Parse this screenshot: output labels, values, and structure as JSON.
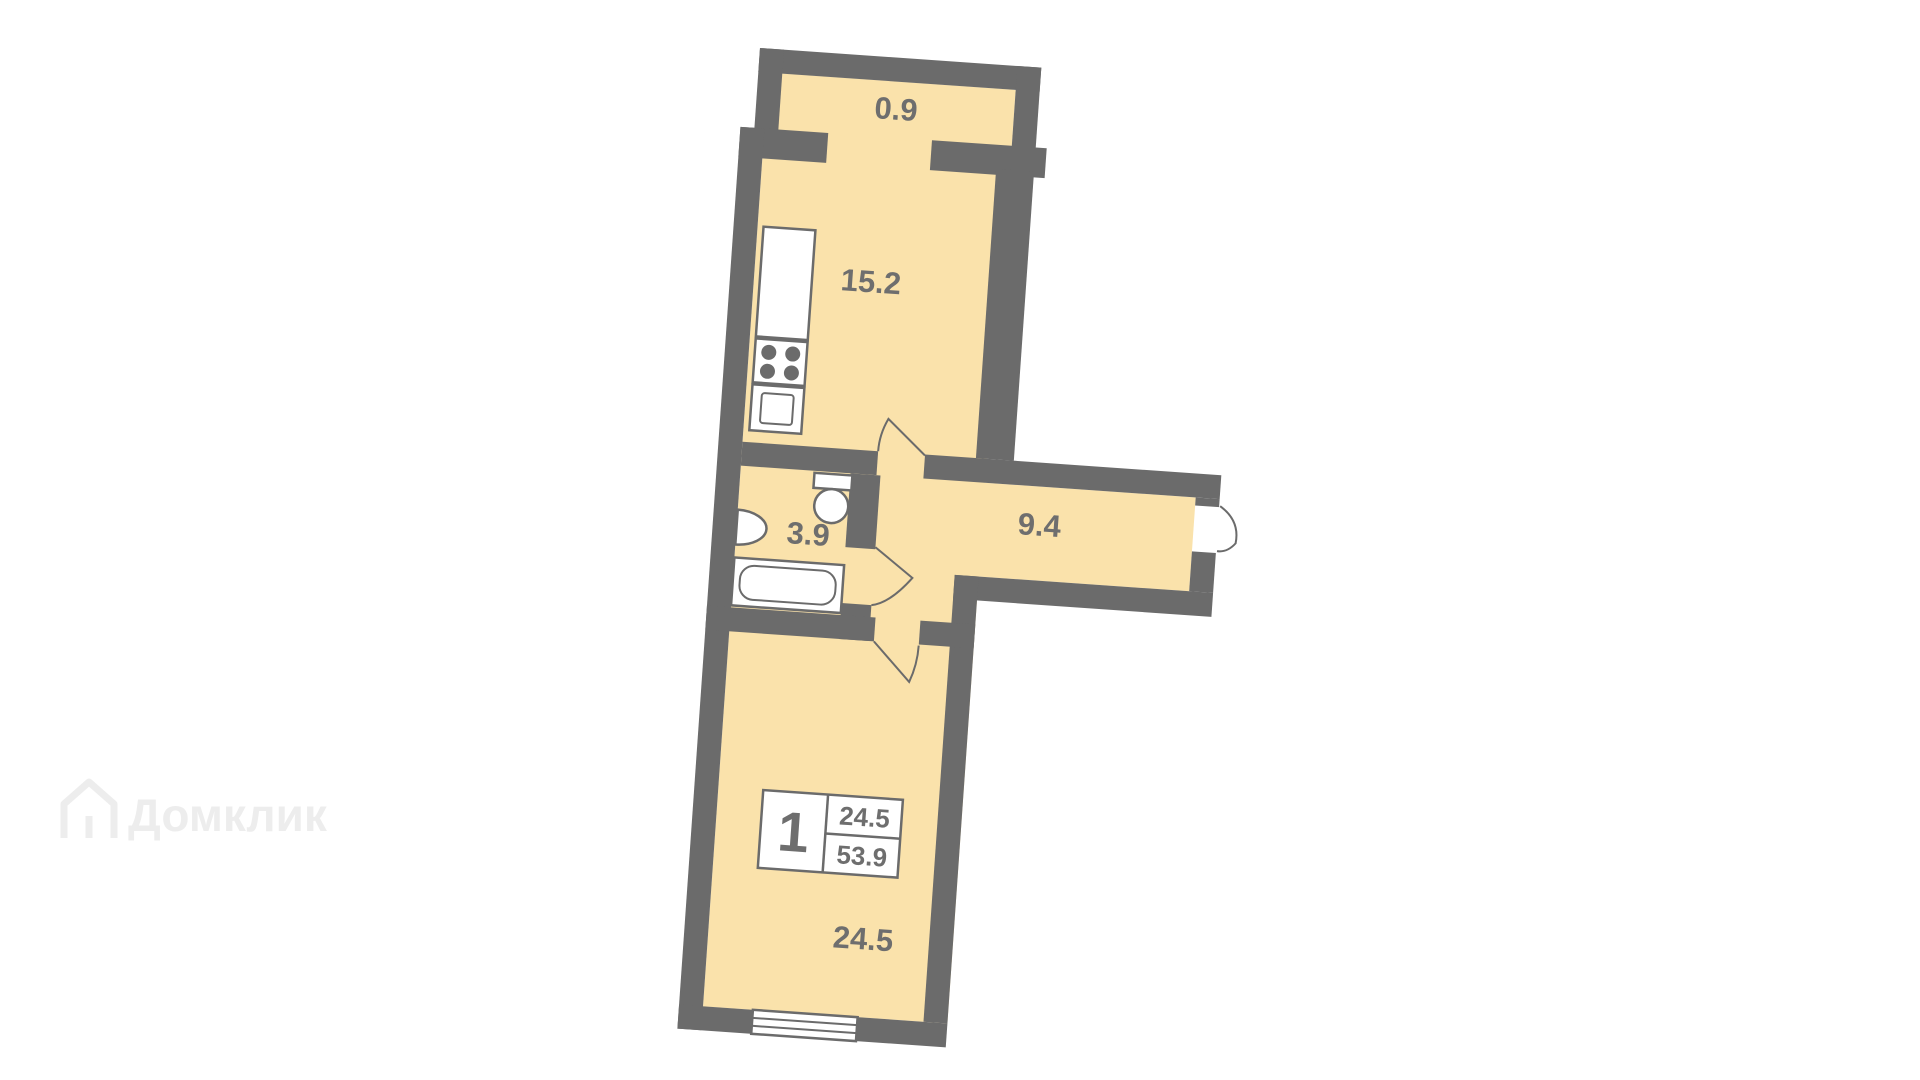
{
  "plan": {
    "type": "apartment-floor-plan",
    "rotation_deg": 4,
    "colors": {
      "floor": "#FAE2AB",
      "wall": "#6B6B6B",
      "fixture_fill": "#FFFFFF",
      "fixture_stroke": "#6B6B6B",
      "label_text": "#6E6E6E",
      "background": "#FFFFFF",
      "watermark": "#EDEDED"
    },
    "rooms": {
      "balcony": {
        "area": "0.9"
      },
      "kitchen": {
        "area": "15.2"
      },
      "bathroom": {
        "area": "3.9"
      },
      "hallway": {
        "area": "9.4"
      },
      "living": {
        "area": "24.5"
      }
    },
    "legend": {
      "rooms_count": "1",
      "living_area": "24.5",
      "total_area": "53.9"
    },
    "fixtures": [
      "kitchen-counter",
      "stove",
      "kitchen-sink-unit",
      "toilet",
      "washbasin",
      "bathtub",
      "window"
    ],
    "doors": [
      "kitchen-door",
      "bathroom-door",
      "living-room-door",
      "entrance-door"
    ]
  },
  "watermark": {
    "text": "Домклик"
  }
}
